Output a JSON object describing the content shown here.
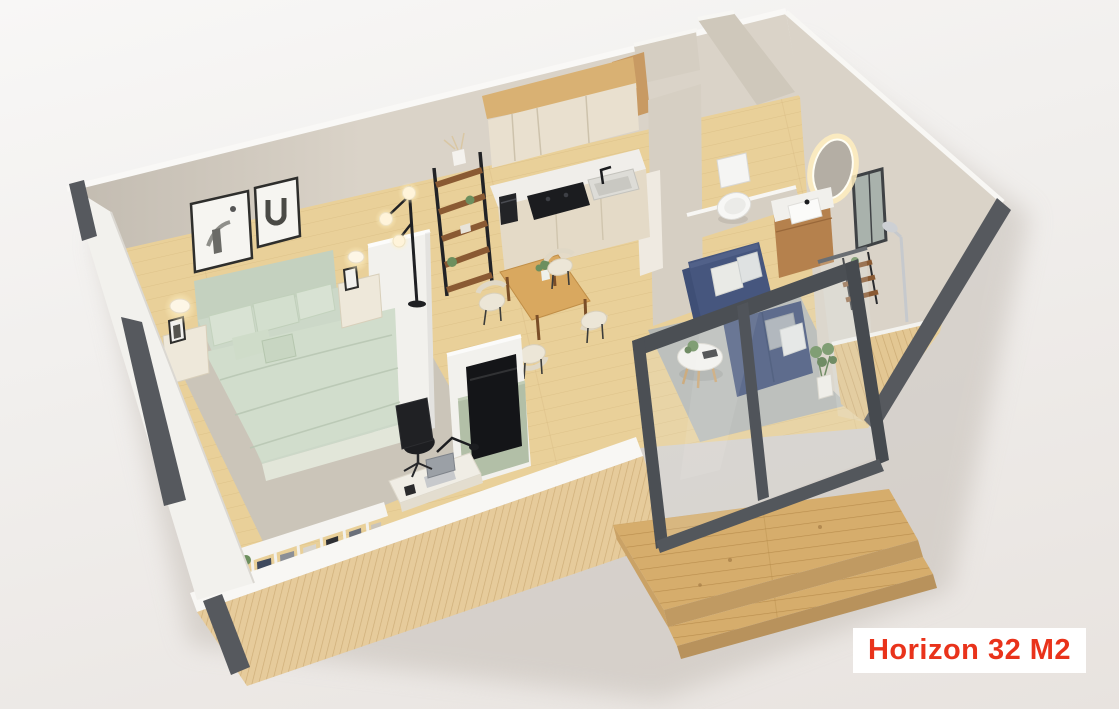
{
  "scene": {
    "type": "3d-floorplan-cutaway-render",
    "subject": "tiny home apartment floor plan, isometric top-down 3D render",
    "rooms": [
      "bedroom",
      "kitchen",
      "dining-area",
      "living-room",
      "bathroom",
      "entry-nook",
      "desk-nook",
      "wardrobe-wall",
      "outdoor-deck"
    ],
    "furniture": [
      "double-bed-sage-bedding",
      "nightstand-left",
      "nightstand-right",
      "table-lamps",
      "wall-art-frames",
      "floor-lamp-globes",
      "ladder-shelf",
      "kitchen-upper-cabinets",
      "kitchen-counter",
      "induction-cooktop",
      "kitchen-sink",
      "coffee-machine",
      "dining-table",
      "dining-chairs-x4",
      "sofa-navy-l-shape",
      "coffee-table-round",
      "area-rug-living",
      "area-rug-bedroom",
      "potted-plants",
      "tv-on-green-console",
      "desk-with-laptop",
      "office-chair",
      "open-wardrobe-clothes",
      "toilet",
      "vanity-with-led-mirror",
      "shower-fixture",
      "bathroom-window",
      "sliding-glass-door",
      "wooden-deck-steps"
    ]
  },
  "label": {
    "text": "Horizon 32 M2"
  },
  "palette": {
    "label_red": "#e9331b",
    "label_bg": "#ffffff",
    "background_top": "#f8f7f6",
    "background_bottom": "#e8e3df",
    "concrete_wall": "#dad3c8",
    "white_partition": "#f2f1ed",
    "floor_wood": "#e9d099",
    "slat_wood": "#e6cb9b",
    "deck_wood": "#d6ad6c",
    "dark_trim": "#56595e",
    "door_frame_gray": "#4b4f54",
    "bed_sage": "#ccd8c8",
    "sofa_navy": "#46567e",
    "dining_table_wood": "#d9a85f",
    "cabinet_cream": "#e9e0cf",
    "appliance_black": "#1b1c1f",
    "vanity_wood": "#b5814d",
    "plant_green": "#6d8f5e",
    "rug_gray": "#b5b8b4",
    "tv_console_green": "#b2bfa7"
  }
}
